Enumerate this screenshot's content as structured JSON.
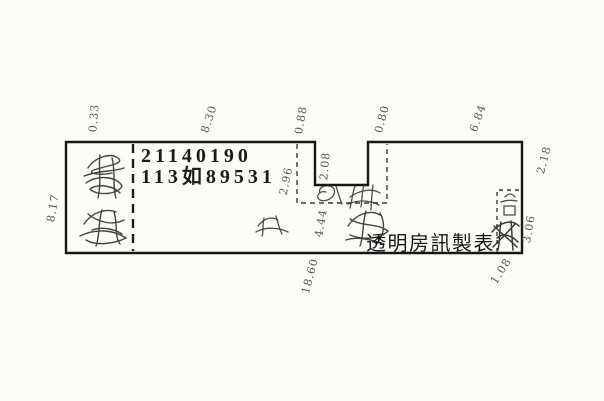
{
  "colors": {
    "ink": "#1b1b1b",
    "dim_label_ink": "#565656",
    "paper": "#fcfcfa"
  },
  "registration": {
    "line1": "21140190",
    "line2": "113如89531"
  },
  "credit": "透明房訊製表",
  "dimensions": {
    "left_top": "0.33",
    "top_left_span": "8.30",
    "notch_left": "0.88",
    "notch_right": "0.80",
    "top_right_span": "6.84",
    "right_upper": "2.18",
    "right_lower": "3.06",
    "bottom_right": "1.08",
    "bottom_span": "18.60",
    "left_side": "8.17",
    "notch_west": "2.96",
    "notch_depth": "2.08",
    "notch_base": "4.44"
  }
}
